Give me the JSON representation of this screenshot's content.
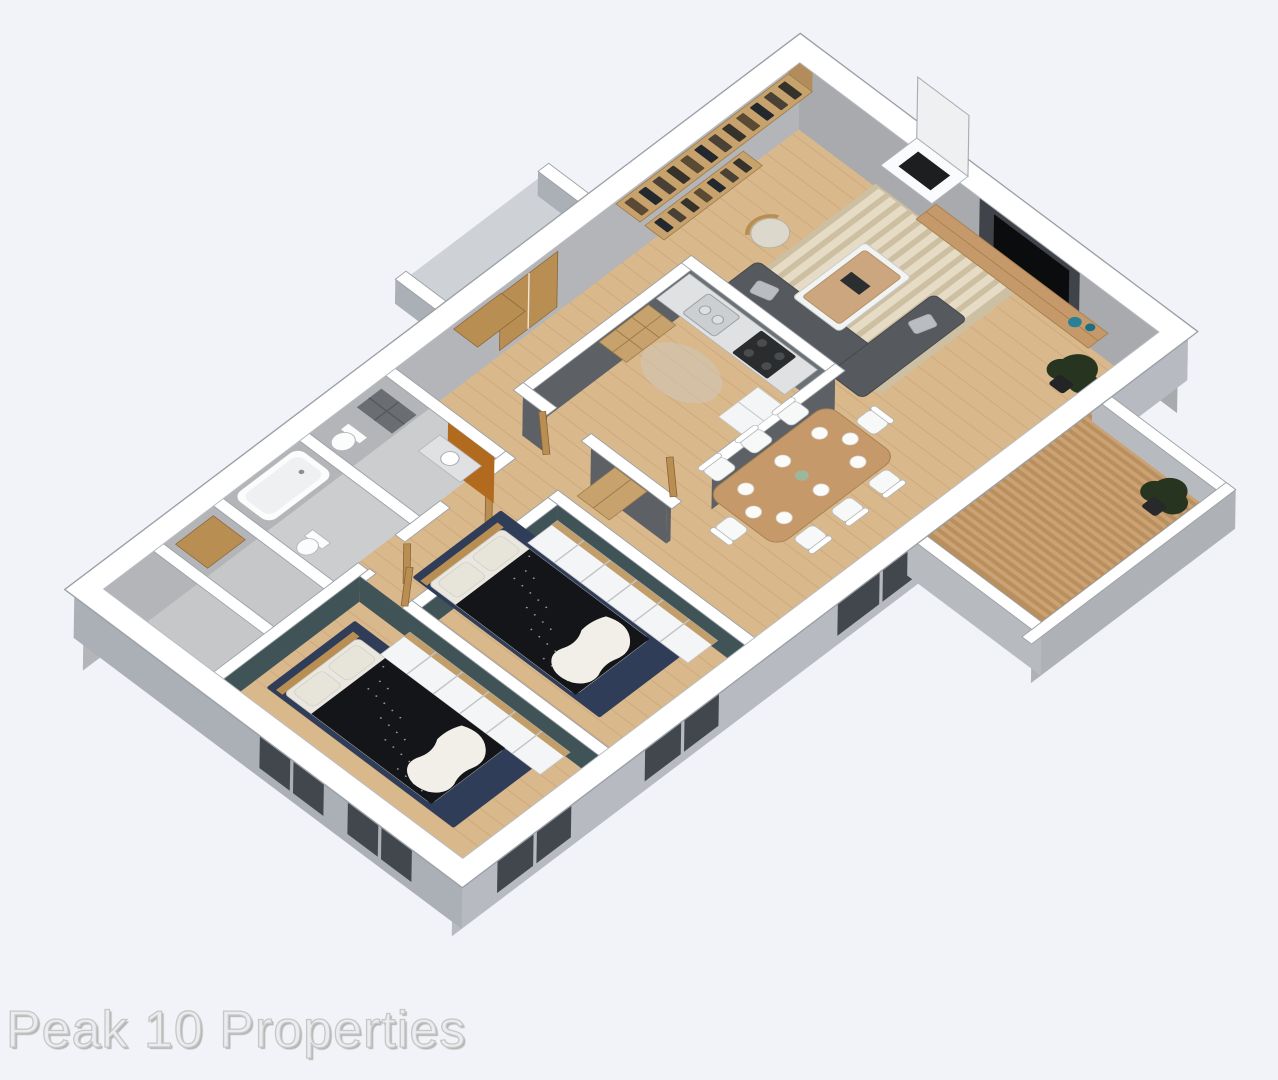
{
  "watermark": {
    "text": "Peak 10 Properties"
  },
  "scene": {
    "type": "3d-floor-plan-render",
    "style": "isometric dollhouse apartment view",
    "rooms": [
      {
        "name": "Living Room",
        "furniture": [
          "bookshelves",
          "fireplace-chimney",
          "tv-media-wall",
          "wood-console",
          "blue-vases",
          "potted-plant",
          "striped-area-rug",
          "l-shaped-sofa",
          "coffee-table",
          "armchair"
        ]
      },
      {
        "name": "Kitchen",
        "furniture": [
          "counter",
          "sink",
          "stove",
          "refrigerator",
          "cube-shelving"
        ]
      },
      {
        "name": "Dining Area",
        "furniture": [
          "dining-table",
          "eight-chairs",
          "place-settings",
          "centerpiece"
        ]
      },
      {
        "name": "Balcony",
        "furniture": [
          "slatted-deck",
          "potted-plant",
          "parapet-walls",
          "sliding-glass-door"
        ]
      },
      {
        "name": "Bedroom 2",
        "furniture": [
          "double-bed",
          "navy-rug",
          "white-wardrobe-row",
          "teal-accent-walls"
        ]
      },
      {
        "name": "Master Bedroom",
        "furniture": [
          "double-bed",
          "navy-rug",
          "white-wardrobe-row",
          "teal-accent-walls"
        ]
      },
      {
        "name": "Bathroom 1",
        "furniture": [
          "vanity",
          "orange-accent-wall",
          "washer-shelving",
          "toilet"
        ]
      },
      {
        "name": "Bathroom 2",
        "furniture": [
          "bathtub",
          "toilet"
        ]
      },
      {
        "name": "Entry",
        "furniture": [
          "wood-double-door",
          "wardrobe"
        ]
      },
      {
        "name": "Hallway",
        "furniture": [
          "wood-cabinet"
        ]
      },
      {
        "name": "Closets",
        "furniture": [
          "wardrobe"
        ]
      }
    ]
  },
  "colors": {
    "bg": "#f1f3f8",
    "wallTop": "#ffffff",
    "wallEdge": "#9aa0a6",
    "backNE": "#a8aaae",
    "backNW": "#b3b5b8",
    "frontSE": "#b7bbc1",
    "frontSW": "#abb0b6",
    "kWall": "#5d6165",
    "kWallL": "#6c7175",
    "teal": "#405458",
    "wood": "#d9b88c",
    "plank": "#c29a6d",
    "bath": "#cbcdce",
    "closet": "#c5c7c9",
    "porch": "#ced2d7",
    "deck": "#b98f5e",
    "slat": "#cba274",
    "rug": "#2f3d58",
    "bedDark": "#141519",
    "linen": "#f1efe7",
    "pillow": "#e7e5da",
    "sofa": "#56595d",
    "sofaP": "#b9bdc1",
    "tblWood": "#c6996a",
    "shelf": "#c8a26c",
    "door": "#b98e52",
    "white": "#f4f5f6",
    "counter": "#dfe1e2",
    "orange": "#b26a1e",
    "glass": "#42474e",
    "vase": "#2a7f99",
    "plant": "#273420",
    "wmColor": "#e9ecf1",
    "wmStroke": "#c7c7c5",
    "wmShadow": "#b4b4b2"
  }
}
